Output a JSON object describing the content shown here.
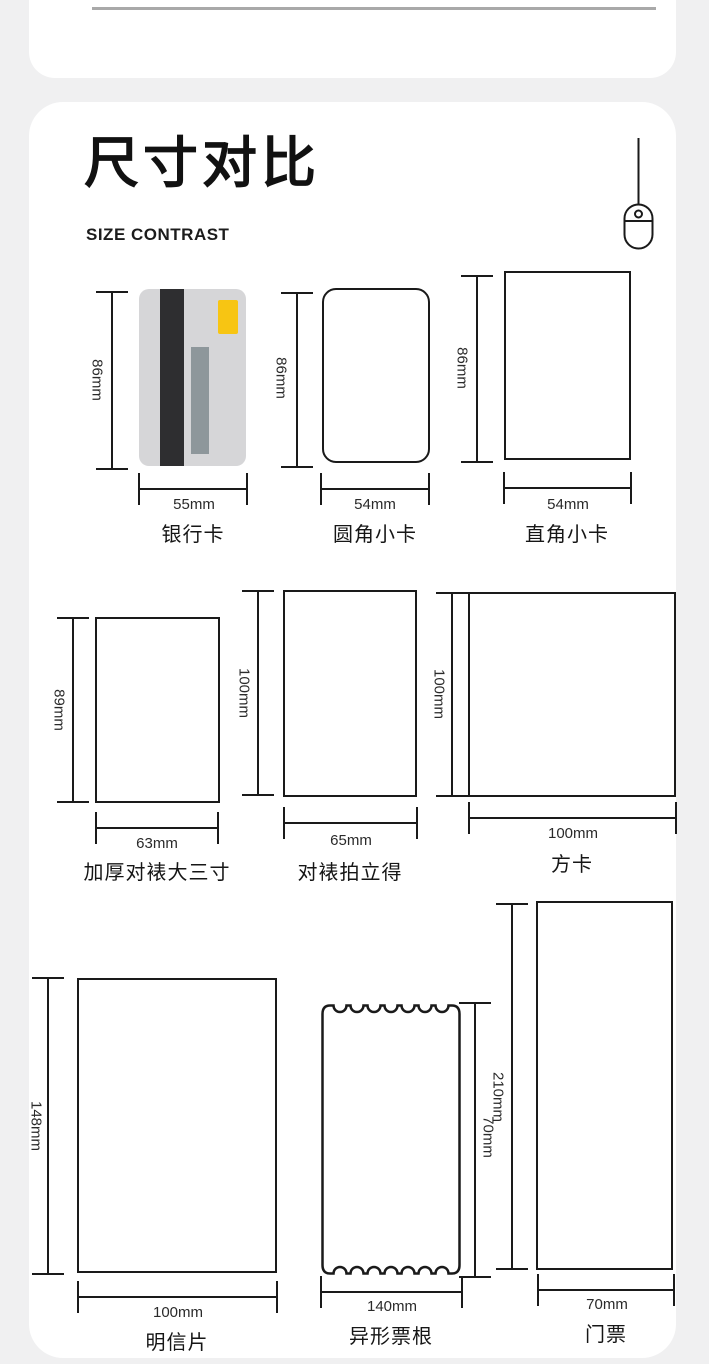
{
  "header": {
    "title": "尺寸对比",
    "subtitle": "SIZE CONTRAST"
  },
  "icons": {
    "mouse": "mouse-icon"
  },
  "colors": {
    "page_bg": "#f0f0f1",
    "panel_bg": "#ffffff",
    "line": "#1a1a1a",
    "divider": "#a9a9a9",
    "bankcard_body": "#d6d6d8",
    "bankcard_stripe_dark": "#2e2e30",
    "bankcard_stripe_gray": "#8e979b",
    "bankcard_chip_yellow": "#f7c513"
  },
  "items": [
    {
      "name": "银行卡",
      "height": "86mm",
      "width": "55mm"
    },
    {
      "name": "圆角小卡",
      "height": "86mm",
      "width": "54mm"
    },
    {
      "name": "直角小卡",
      "height": "86mm",
      "width": "54mm"
    },
    {
      "name": "加厚对裱大三寸",
      "height": "89mm",
      "width": "63mm"
    },
    {
      "name": "对裱拍立得",
      "height": "100mm",
      "width": "65mm"
    },
    {
      "name": "方卡",
      "height": "100mm",
      "width": "100mm"
    },
    {
      "name": "明信片",
      "height": "148mm",
      "width": "100mm"
    },
    {
      "name": "异形票根",
      "height": "70mm",
      "width": "140mm"
    },
    {
      "name": "门票",
      "height": "210mm",
      "width": "70mm"
    }
  ]
}
